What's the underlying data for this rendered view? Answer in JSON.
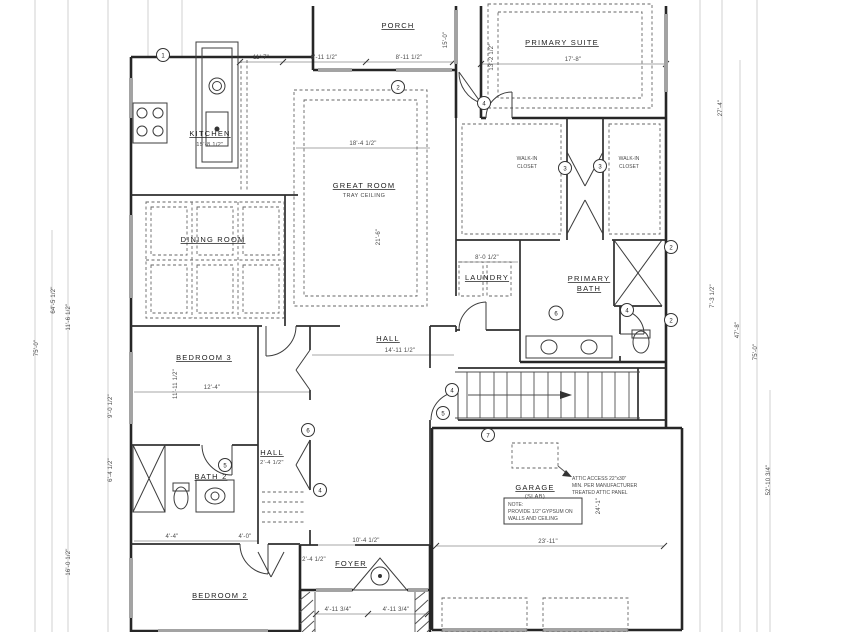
{
  "rooms": {
    "porch": "PORCH",
    "primary_suite": "PRIMARY SUITE",
    "kitchen": "KITCHEN",
    "kitchen_dim": "15'-8 1/2\"",
    "great_room": "GREAT ROOM",
    "great_room_sub": "TRAY CEILING",
    "dining_room": "DINING ROOM",
    "laundry": "LAUNDRY",
    "primary_bath1": "PRIMARY",
    "primary_bath2": "BATH",
    "bedroom3": "BEDROOM 3",
    "hall_upper": "HALL",
    "hall_lower": "HALL",
    "hall_lower_dim": "2'-4 1/2\"",
    "bath2": "BATH 2",
    "garage": "GARAGE",
    "garage_sub": "(SLAB)",
    "foyer": "FOYER",
    "bedroom2": "BEDROOM 2",
    "wic1a": "WALK-IN",
    "wic1b": "CLOSET",
    "wic2a": "WALK-IN",
    "wic2b": "CLOSET"
  },
  "dims": {
    "top_a": "11'-7\"",
    "top_b": "8'-11 1/2\"",
    "top_c": "8'-11 1/2\"",
    "porch_depth": "15'-0\"",
    "suite_w": "17'-8\"",
    "suite_side": "13'-2 1/2\"",
    "great_w": "18'-4 1/2\"",
    "great_h": "21'-6\"",
    "laundry_w": "8'-0 1/2\"",
    "hall_w": "14'-11 1/2\"",
    "bed3_w": "12'-4\"",
    "bed3_h": "11'-11 1/2\"",
    "bath2_a": "4'-4\"",
    "bath2_b": "4'-0\"",
    "foyer_w": "10'-4 1/2\"",
    "foyer_a": "2'-4 1/2\"",
    "garage_w": "23'-11\"",
    "garage_h": "24'-1\"",
    "stoop_a": "4'-11 3/4\"",
    "stoop_b": "4'-11 3/4\"",
    "left_total": "75'-0\"",
    "left_a": "64'-5 1/2\"",
    "left_b": "11'-6 1/2\"",
    "left_c": "9'-0 1/2\"",
    "left_d": "6'-4 1/2\"",
    "left_e": "16'-0 1/2\"",
    "right_a": "27'-4\"",
    "right_b": "7'-3 1/2\"",
    "right_c": "47'-8\"",
    "right_total": "75'-0\"",
    "right_d": "52'-10 3/4\""
  },
  "notes": {
    "attic1": "ATTIC ACCESS 22\"x30\"",
    "attic2": "MIN. PER MANUFACTURER",
    "attic3": "TREATED ATTIC PANEL",
    "note_title": "NOTE:",
    "note1": "PROVIDE 1/2\" GYPSUM ON",
    "note2": "WALLS AND CEILING"
  },
  "keynotes": {
    "a": "1",
    "b": "2",
    "c": "4",
    "d": "3",
    "e": "3",
    "f": "6",
    "g": "4",
    "h": "4",
    "i": "5",
    "j": "6",
    "k": "5",
    "l": "4",
    "m": "7",
    "n": "2",
    "o": "2"
  }
}
